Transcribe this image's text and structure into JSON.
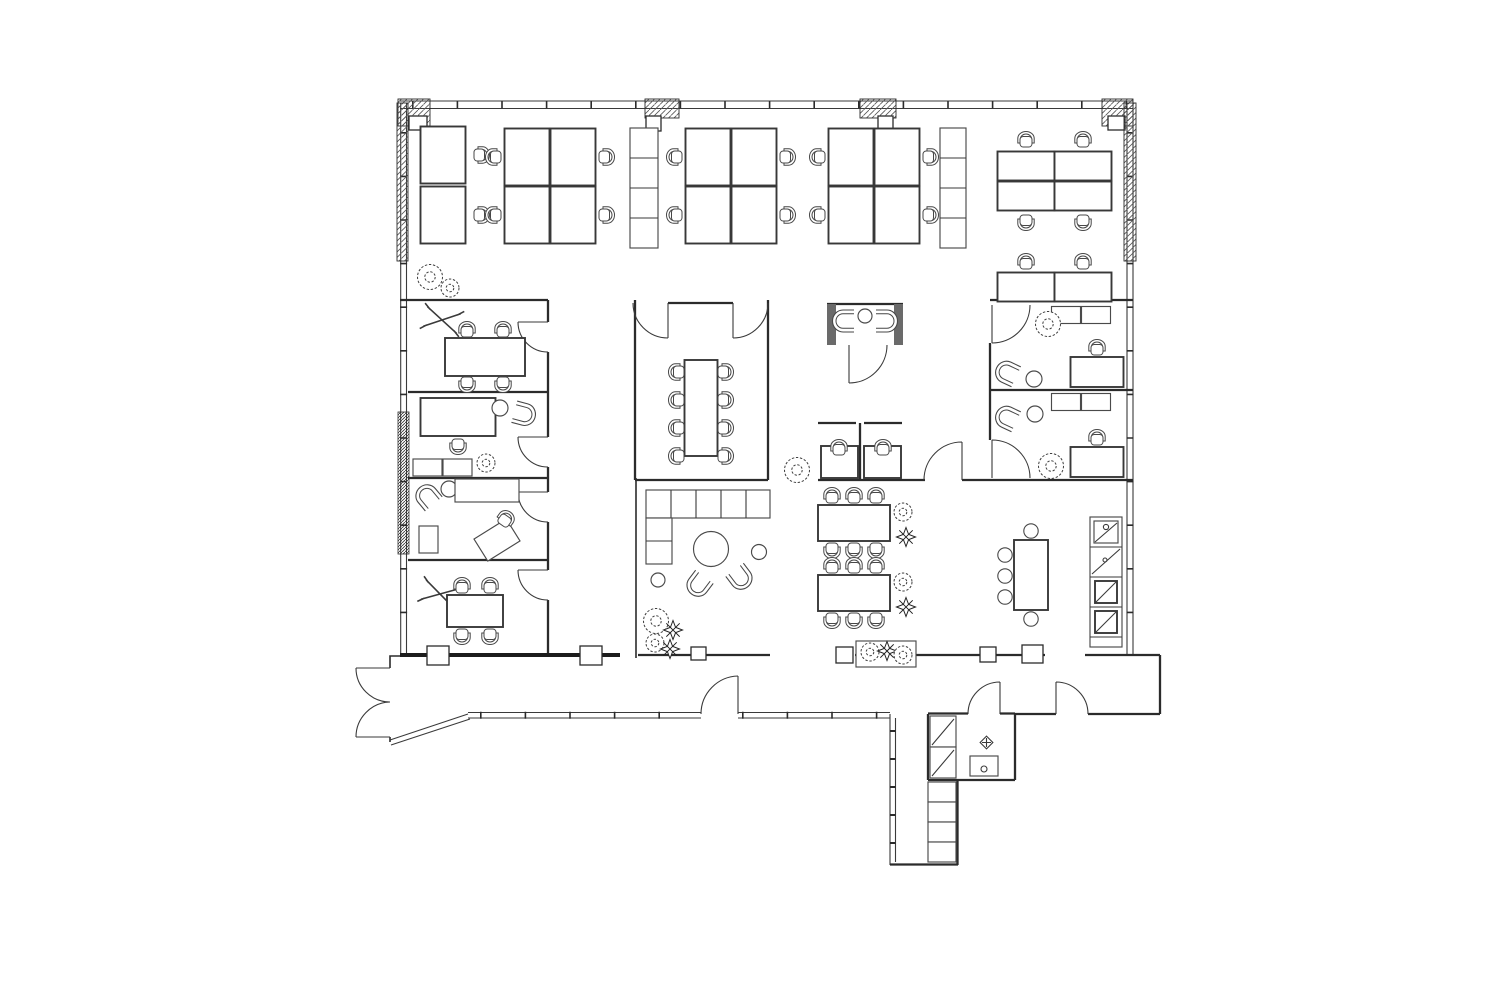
{
  "page": {
    "background": "#ffffff",
    "copyright": "© Technopolis"
  },
  "plan": {
    "labels": {
      "desk": "1600x800",
      "meeting_table": "1800x800",
      "conference_table": "3000x1000",
      "cafe_table": "2400x1000",
      "phone_booth_desk": "1200x700"
    },
    "cleaning_room": {
      "dim": "600",
      "number": "6348",
      "code": "SK"
    },
    "colors": {
      "wall_line": "#2b2b2b",
      "furniture_line": "#4a4a4a",
      "dimension_label": "#8a4a40",
      "room_label": "#c2c2c2",
      "copyright_text": "#3f3f3f"
    }
  }
}
